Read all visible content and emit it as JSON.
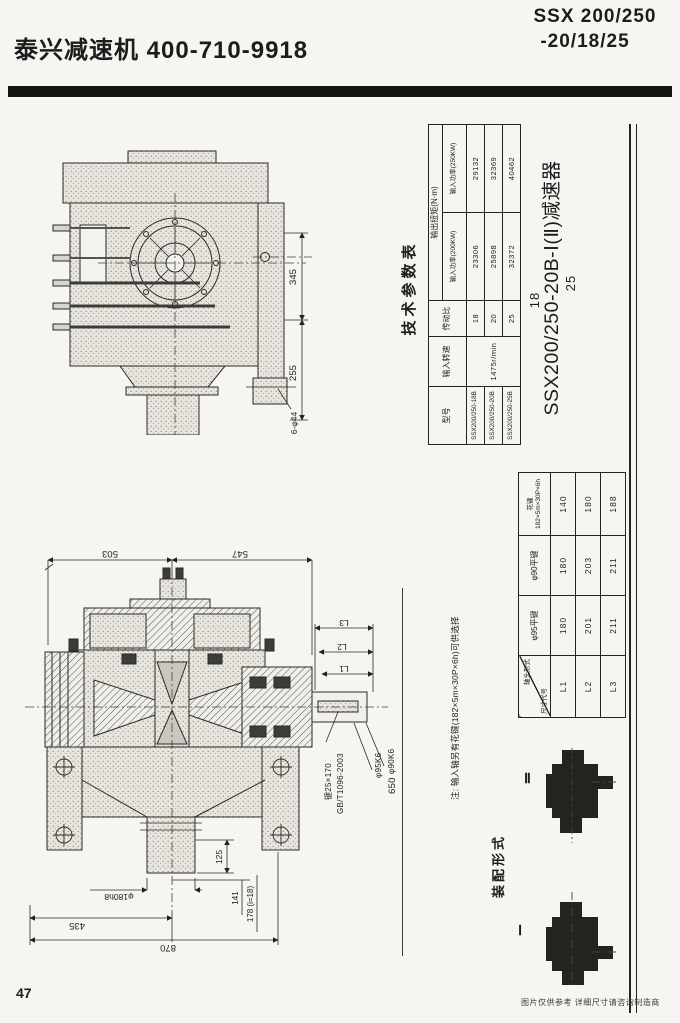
{
  "header": {
    "brand": "泰兴减速机  400-710-9918",
    "model_line1": "SSX 200/250",
    "model_line2": "-20/18/25"
  },
  "params_table": {
    "title": "技术参数表",
    "col_model": "型号",
    "col_speed": "输入转速",
    "col_ratio": "传动比",
    "col_torque": "输出扭矩(N·m)",
    "col_power200": "输入功率(200KW)",
    "col_power250": "输入功率(250KW)",
    "rows": [
      {
        "model": "SSX200/250-18B",
        "speed": "1475r/min",
        "ratio": "18",
        "t200": "23306",
        "t250": "29132"
      },
      {
        "model": "SSX200/250-20B",
        "ratio": "20",
        "t200": "25898",
        "t250": "32369"
      },
      {
        "model": "SSX200/250-25B",
        "ratio": "25",
        "t200": "32372",
        "t250": "40462"
      }
    ]
  },
  "product_title": {
    "alt_top": "18",
    "main": "SSX200/250-20B-Ⅰ(Ⅱ)减速器",
    "alt_bottom": "25"
  },
  "dims_table": {
    "corner_top": "轴头形式",
    "corner_bottom": "尺寸代号",
    "col1": "φ95平键",
    "col2": "φ90平键",
    "col3_line1": "花键",
    "col3_line2": "182×5m×30P×6h",
    "rows": [
      {
        "code": "L1",
        "v1": "180",
        "v2": "180",
        "v3": "140"
      },
      {
        "code": "L2",
        "v1": "201",
        "v2": "203",
        "v3": "180"
      },
      {
        "code": "L3",
        "v1": "211",
        "v2": "211",
        "v3": "188"
      }
    ]
  },
  "note": "注: 输入轴另有花键(182×5m×30P×6h)可供选择",
  "drawing_top": {
    "dim_345": "345",
    "dim_255": "255",
    "dim_bolt": "6-φ44"
  },
  "drawing_front": {
    "dim_503": "503",
    "dim_547": "547",
    "dim_L1": "L1",
    "dim_L2": "L2",
    "dim_L3": "L3",
    "key_label": "键25×170",
    "key_std": "GB/T1096-2003",
    "dia_95": "φ95K6",
    "dia_90": "φ90K6",
    "dim_650": "650",
    "dim_125": "125",
    "dim_141": "141",
    "dim_178": "178 (i=18)",
    "dia_180": "φ180h8",
    "dim_435": "435",
    "dim_870": "870"
  },
  "assembly": {
    "title": "装配形式",
    "form_2": "Ⅱ",
    "form_1": "Ⅰ"
  },
  "footer": {
    "page_number": "47",
    "disclaimer": "图片仅供参考   详细尺寸请咨询制造商"
  },
  "colors": {
    "ink": "#1c1c1c",
    "paper": "#f6f5f1"
  }
}
